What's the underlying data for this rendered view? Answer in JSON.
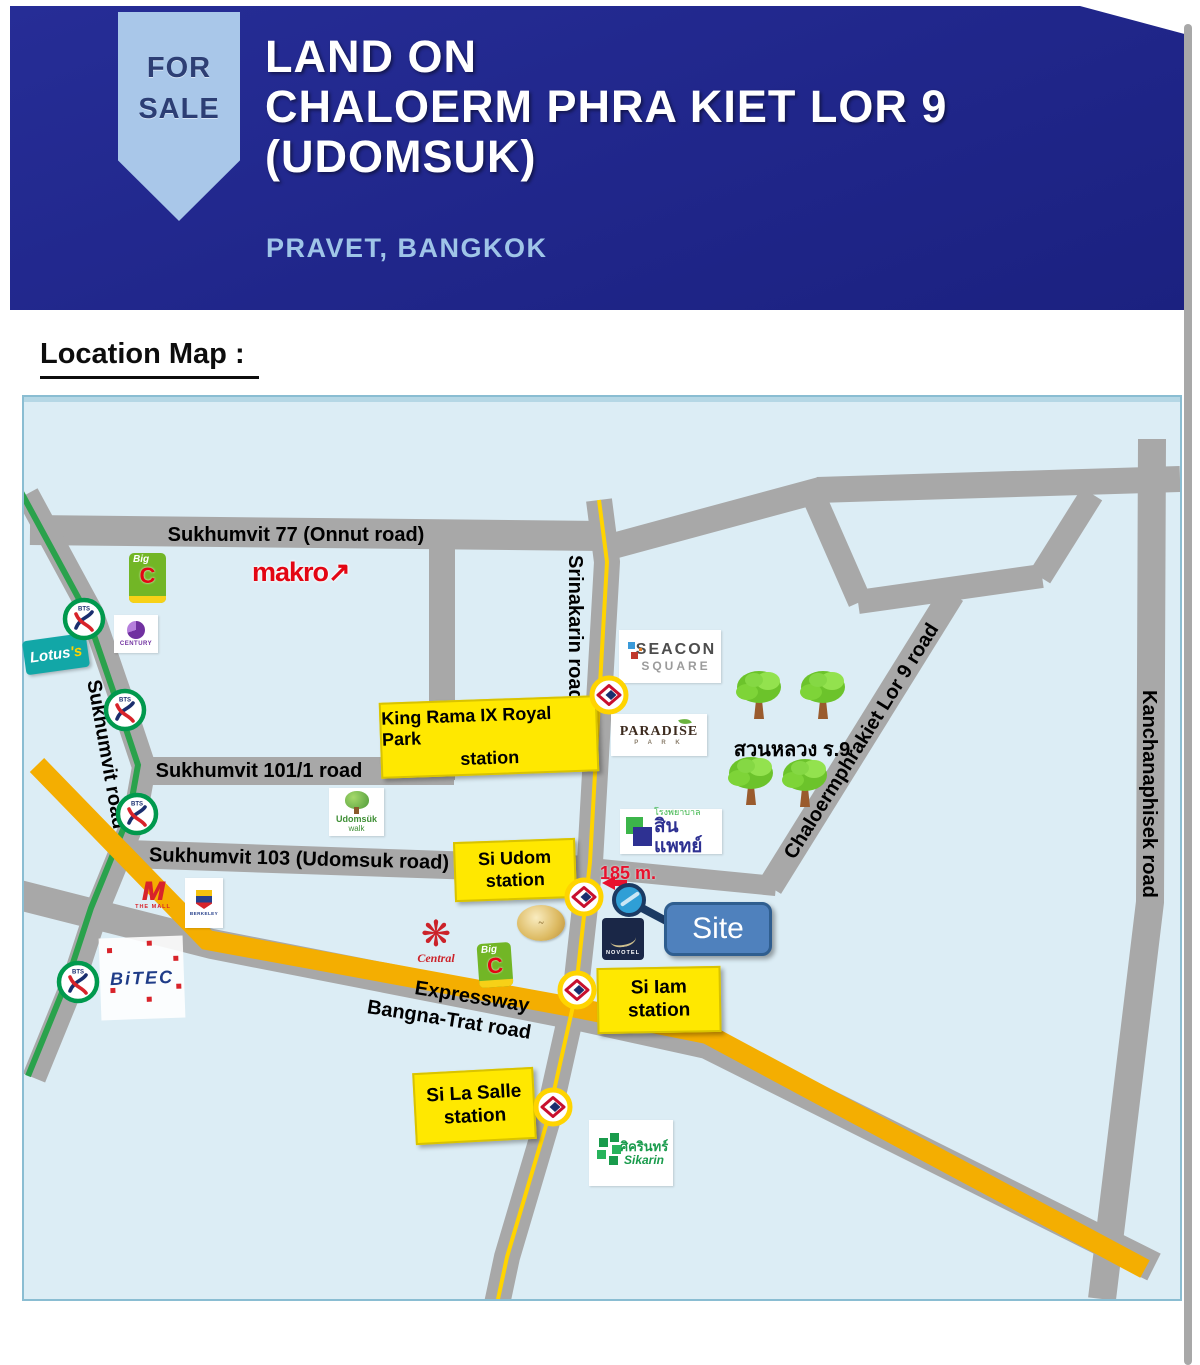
{
  "header": {
    "ribbon_line1": "FOR",
    "ribbon_line2": "SALE",
    "title_line1": "LAND ON",
    "title_line2": "CHALOERM PHRA KIET LOR 9",
    "title_line3": "(UDOMSUK)",
    "subtitle": "PRAVET, BANGKOK"
  },
  "section_heading": "Location Map :",
  "map": {
    "road_labels": {
      "sukhumvit77": "Sukhumvit 77 (Onnut road)",
      "sukhumvit_road": "Sukhumvit road",
      "sukhumvit101": "Sukhumvit  101/1 road",
      "sukhumvit103": "Sukhumvit 103 (Udomsuk road)",
      "srinakarin": "Srinakarin road",
      "chaloermphrakiet": "Chaloermphrakiet Lor 9 road",
      "kanchanaphisek": "Kanchanaphisek road",
      "expressway_line1": "Expressway",
      "expressway_line2": "Bangna-Trat road"
    },
    "stations": {
      "king_rama": {
        "line1": "King Rama IX Royal Park",
        "line2": "station"
      },
      "si_udom": {
        "line1": "Si Udom",
        "line2": "station"
      },
      "si_iam": {
        "line1": "Si Iam",
        "line2": "station"
      },
      "si_la_salle": {
        "line1": "Si La Salle",
        "line2": "station"
      }
    },
    "site": {
      "label": "Site",
      "distance": "185 m."
    },
    "park_label": "สวนหลวง ร.9",
    "places": {
      "makro": "makro",
      "makro_arrow": "↗",
      "bigc_big": "Big",
      "bigc_c": "C",
      "lotus_main": "Lotus",
      "lotus_suffix": "'s",
      "century": "CENTURY",
      "udomsuk_line1": "Udomsük",
      "udomsuk_line2": "walk",
      "the_mall_m": "M",
      "the_mall": "THE MALL",
      "berkeley": "BERKELEY",
      "bitec": "BiTEC",
      "central": "Central",
      "central_flower": "❋",
      "seacon_line1": "SEACON",
      "seacon_line2": "SQUARE",
      "paradise_line1": "PARADISE",
      "paradise_line2": "P A R K",
      "hospital_line1": "โรงพยาบาล",
      "hospital_line2": "สินแพทย์",
      "novotel": "NOVOTEL",
      "sikarin_line1": "ศิครินทร์",
      "sikarin_line2": "Sikarin"
    },
    "colors": {
      "map_bg": "#dcedf5",
      "road_gray": "#a8a8a8",
      "expressway_orange": "#f4ae01",
      "bts_green_line": "#2aa24c",
      "mrt_yellow_line": "#ffd400",
      "station_label_yellow": "#ffe800",
      "site_blue": "#4f81bd",
      "banner_blue": "#20268a",
      "ribbon_blue": "#a9c7e9"
    }
  }
}
